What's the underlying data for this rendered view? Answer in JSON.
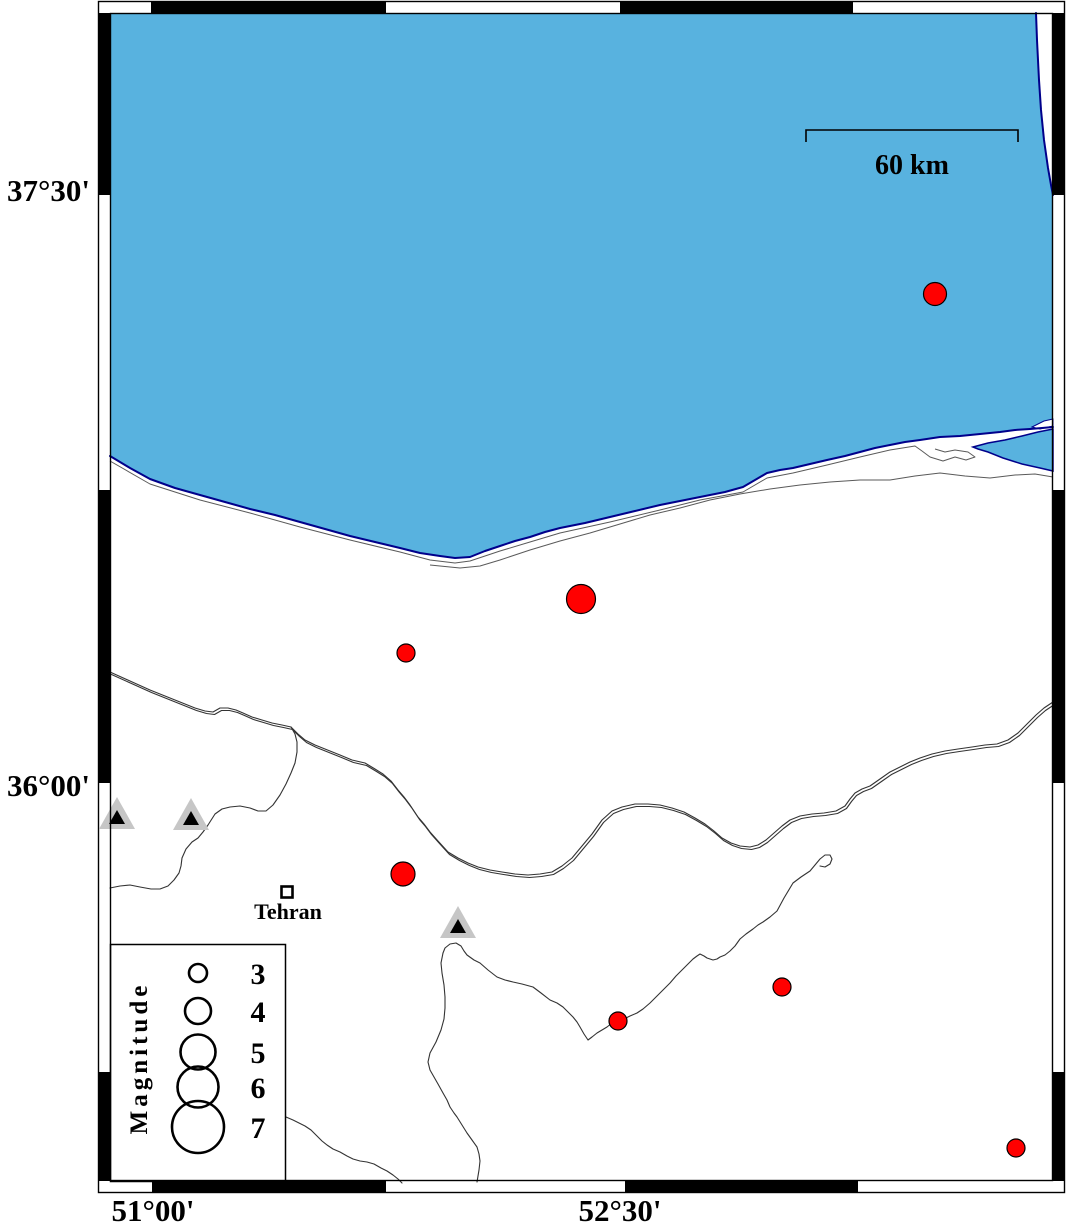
{
  "map": {
    "axis_labels": {
      "left": [
        {
          "text": "37°30'"
        },
        {
          "text": "36°00'"
        }
      ],
      "bottom": [
        {
          "text": "51°00'"
        },
        {
          "text": "52°30'"
        }
      ]
    },
    "scale_bar": {
      "label": "60 km"
    },
    "city": {
      "name": "Tehran",
      "x": 287,
      "y": 892
    },
    "legend": {
      "title": "Magnitude",
      "entries": [
        {
          "magnitude": "3",
          "r": 9,
          "cy": 973,
          "num_y": 984
        },
        {
          "magnitude": "4",
          "r": 13,
          "cy": 1011,
          "num_y": 1022
        },
        {
          "magnitude": "5",
          "r": 17.5,
          "cy": 1052,
          "num_y": 1063
        },
        {
          "magnitude": "6",
          "r": 20.5,
          "cy": 1087,
          "num_y": 1098
        },
        {
          "magnitude": "7",
          "r": 26,
          "cy": 1127,
          "num_y": 1138
        }
      ]
    },
    "earthquakes": [
      {
        "x": 935,
        "y": 294,
        "r": 11.5
      },
      {
        "x": 581,
        "y": 599,
        "r": 14.5
      },
      {
        "x": 406,
        "y": 653,
        "r": 9
      },
      {
        "x": 403,
        "y": 874,
        "r": 12
      },
      {
        "x": 618,
        "y": 1021,
        "r": 9
      },
      {
        "x": 782,
        "y": 987,
        "r": 9
      },
      {
        "x": 1016,
        "y": 1148,
        "r": 9
      }
    ],
    "volcanoes": [
      {
        "x": 117,
        "y": 813
      },
      {
        "x": 191,
        "y": 814
      },
      {
        "x": 458,
        "y": 922
      }
    ],
    "colors": {
      "sea": "#58B2DF",
      "coast_outline": "#00008B",
      "epicenter": "#FF0000",
      "volcano_fill": "#C6C6C6",
      "volcano_inner": "#000000"
    }
  }
}
